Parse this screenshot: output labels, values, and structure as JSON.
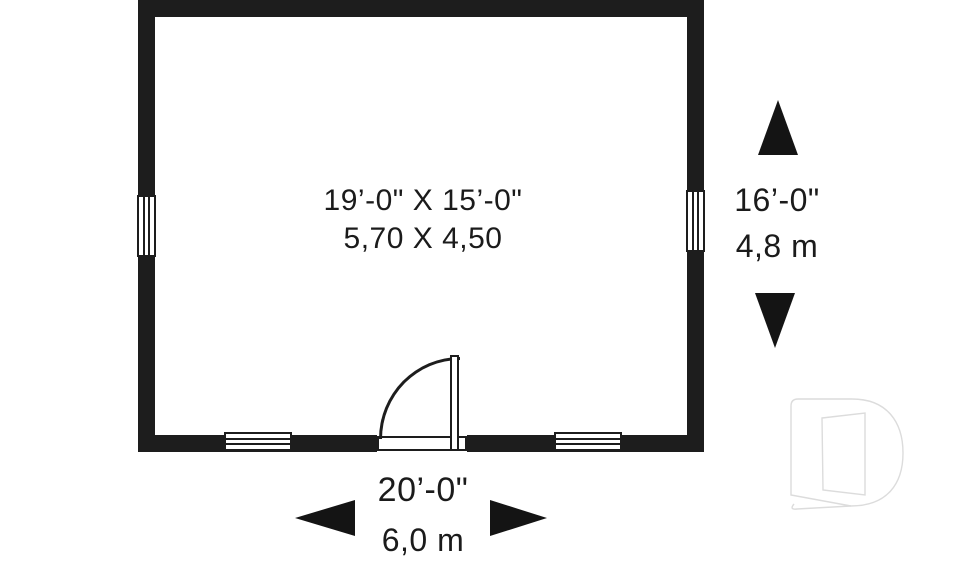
{
  "plan": {
    "room": {
      "size_imperial": "19’-0\" X 15’-0\"",
      "size_metric": "5,70 X 4,50"
    },
    "depth_dimension": {
      "imperial": "16’-0\"",
      "metric": "4,8 m"
    },
    "width_dimension": {
      "imperial": "20’-0\"",
      "metric": "6,0 m"
    }
  },
  "icons": {
    "arrow_up": "dimension-arrow-up",
    "arrow_down": "dimension-arrow-down",
    "arrow_left": "dimension-arrow-left",
    "arrow_right": "dimension-arrow-right",
    "logo": "d-open-door-logo-watermark"
  },
  "colors": {
    "wall": "#1d1d1d",
    "text": "#1b1b1b",
    "background": "#ffffff",
    "logo_outline": "#dcdcdc"
  }
}
